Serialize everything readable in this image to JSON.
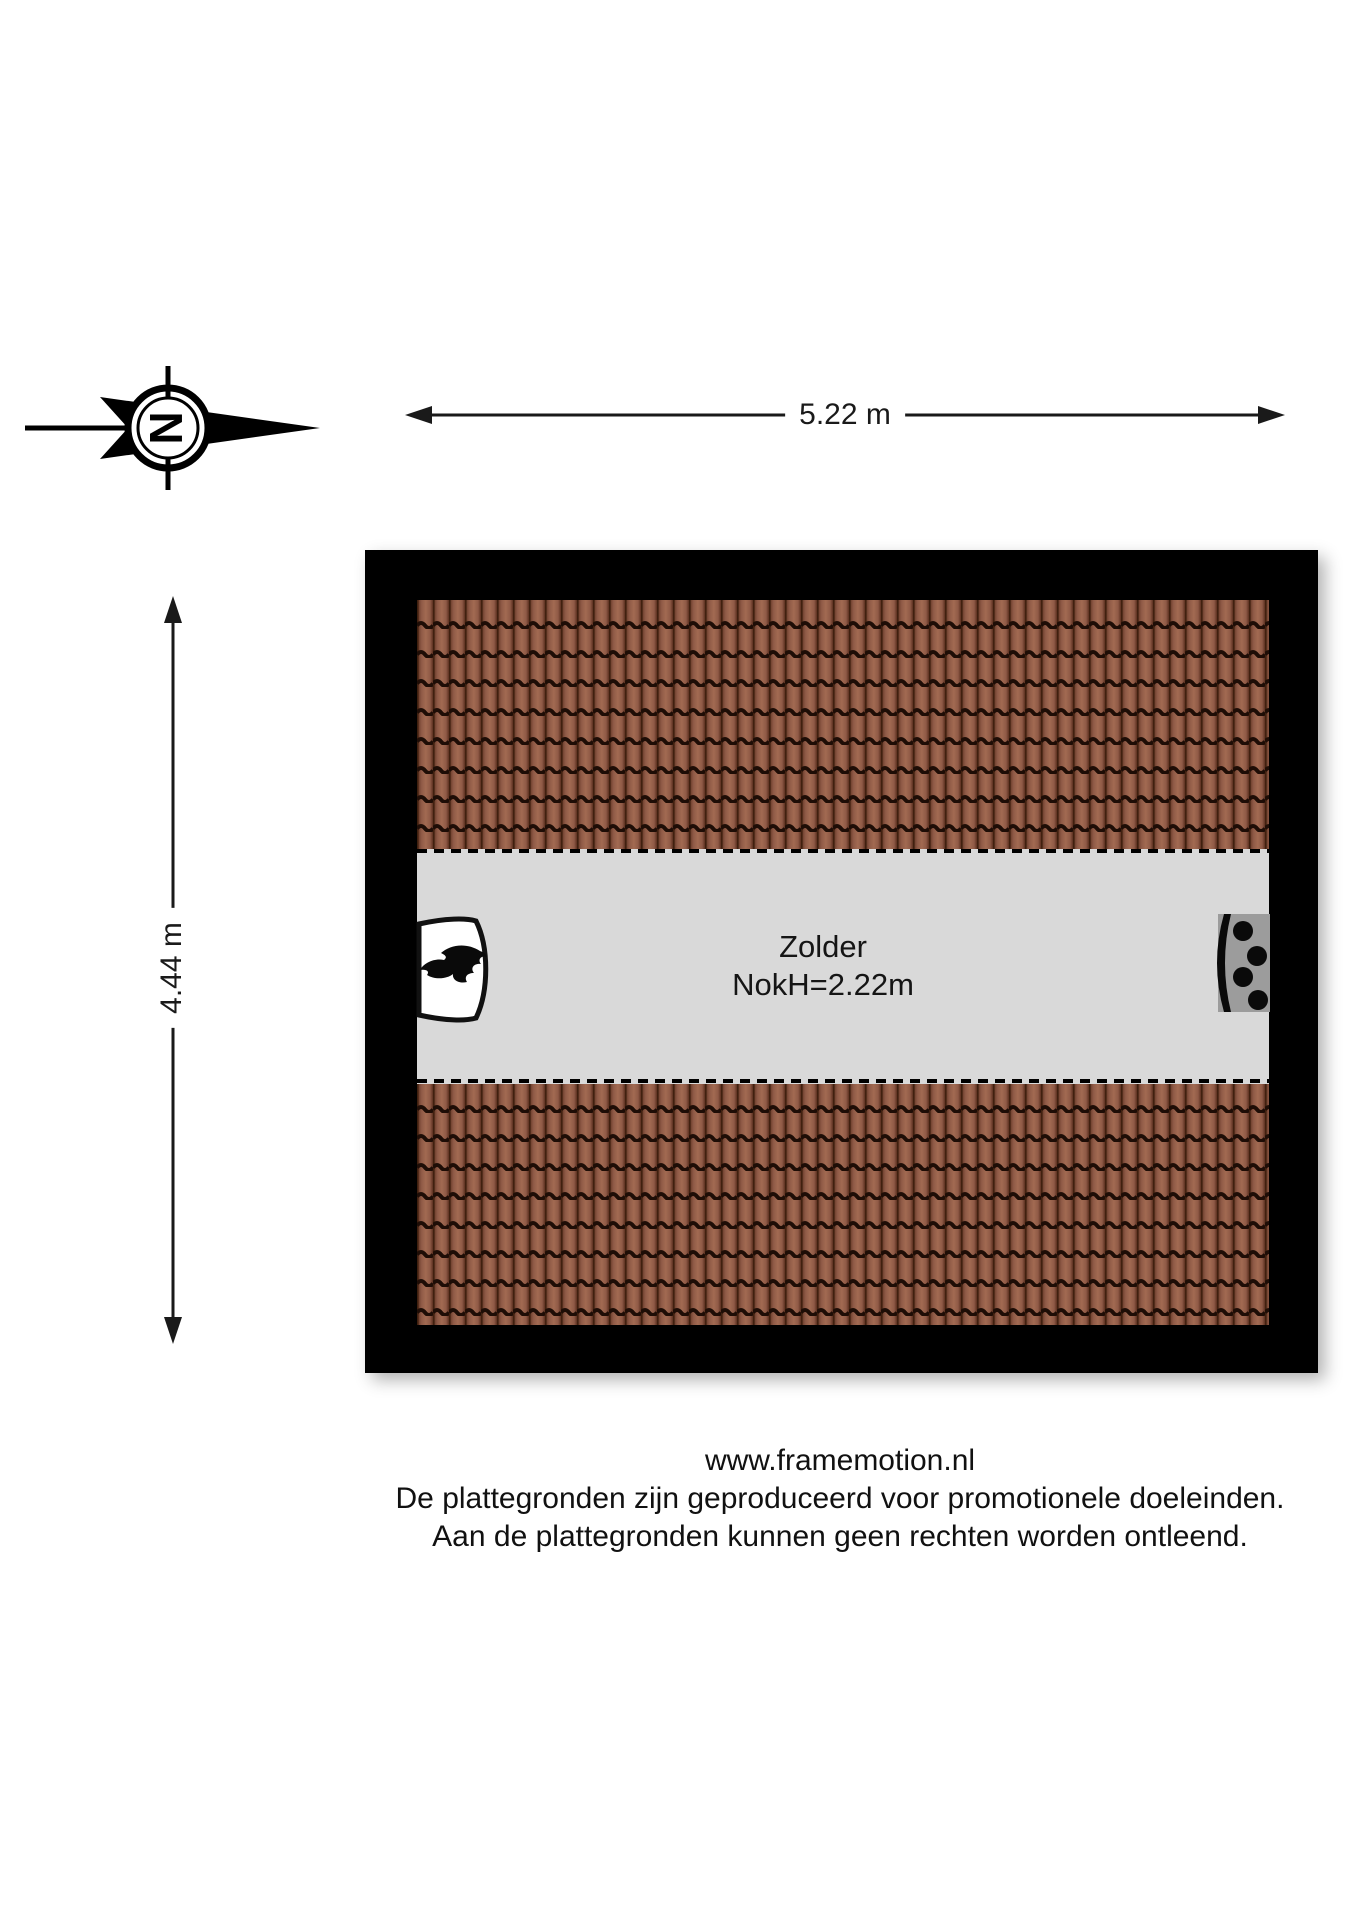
{
  "compass": {
    "letter": "N"
  },
  "dimensions": {
    "width": "5.22 m",
    "height": "4.44 m"
  },
  "room": {
    "name": "Zolder",
    "ridge_height": "NokH=2.22m"
  },
  "icons": {
    "compass": "north-arrow-icon",
    "left_wall": "fireplace-flame-icon",
    "right_wall": "boiler-icon"
  },
  "colors": {
    "wall": "#000000",
    "floor": "#d9d9d9",
    "tile_light": "#a26a52",
    "tile_mid": "#8f5a46",
    "tile_shadow": "#5c3020",
    "tile_joint": "#1e0d06",
    "boiler_gray": "#9c9c9c",
    "line": "#1a1a1a"
  },
  "footer": {
    "lines": [
      "www.framemotion.nl",
      "De plattegronden zijn geproduceerd voor promotionele doeleinden.",
      "Aan de plattegronden kunnen geen rechten worden ontleend."
    ]
  }
}
